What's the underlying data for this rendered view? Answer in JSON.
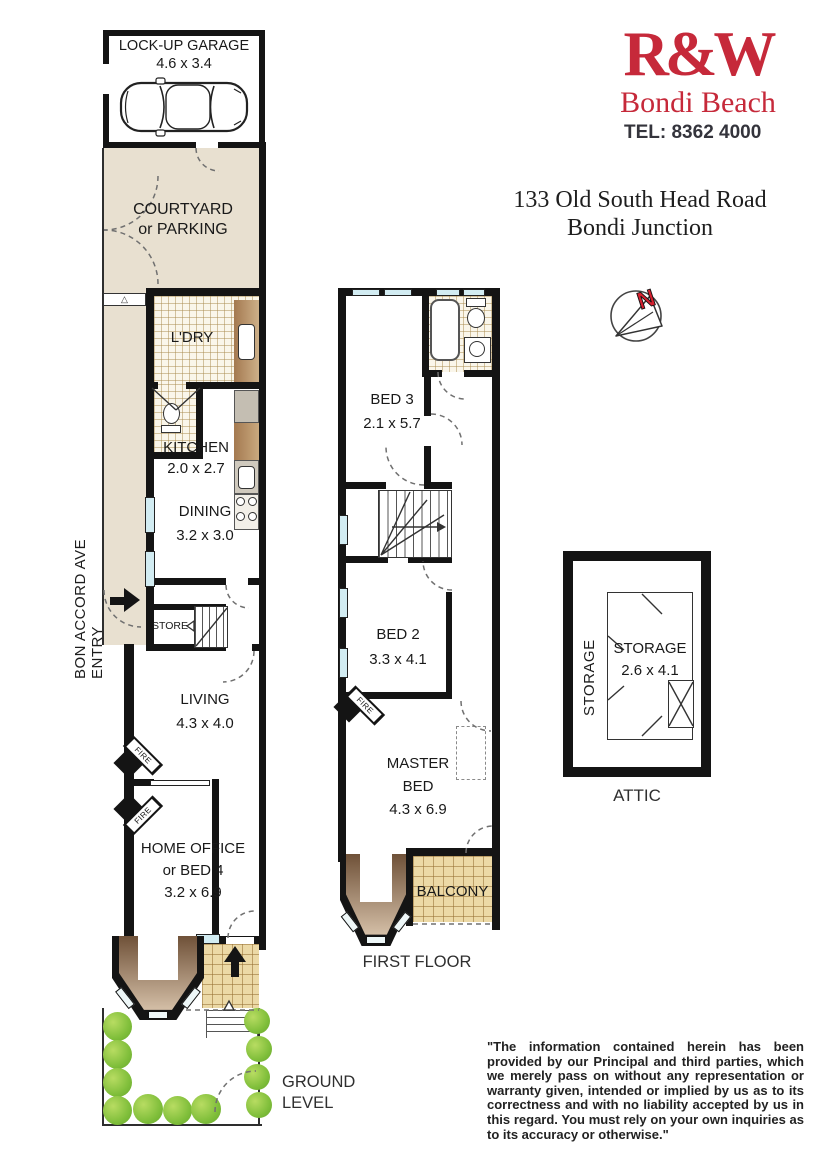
{
  "branding": {
    "logo_text": "R&W",
    "office": "Bondi Beach",
    "phone": "TEL: 8362 4000"
  },
  "address": {
    "line1": "133 Old South Head Road",
    "line2": "Bondi Junction"
  },
  "side_street_label": "BON ACCORD AVE ENTRY",
  "compass": {
    "letter": "N"
  },
  "level_labels": {
    "ground_line1": "GROUND",
    "ground_line2": "LEVEL",
    "first": "FIRST FLOOR",
    "attic": "ATTIC"
  },
  "rooms": {
    "garage": {
      "name": "LOCK-UP GARAGE",
      "dims": "4.6 x 3.4"
    },
    "courtyard": {
      "line1": "COURTYARD",
      "line2": "or PARKING"
    },
    "laundry": {
      "name": "L'DRY"
    },
    "kitchen": {
      "name": "KITCHEN",
      "dims": "2.0 x 2.7"
    },
    "dining": {
      "name": "DINING",
      "dims": "3.2 x 3.0"
    },
    "store": {
      "name": "STORE"
    },
    "living": {
      "name": "LIVING",
      "dims": "4.3 x 4.0"
    },
    "home_office": {
      "line1": "HOME OFFICE",
      "line2": "or BED 4",
      "dims": "3.2 x 6.9"
    },
    "bed3": {
      "name": "BED 3",
      "dims": "2.1 x 5.7"
    },
    "bed2": {
      "name": "BED 2",
      "dims": "3.3 x 4.1"
    },
    "master_bed": {
      "line1": "MASTER",
      "line2": "BED",
      "dims": "4.3 x 6.9"
    },
    "balcony": {
      "name": "BALCONY"
    },
    "attic_storage": {
      "name": "STORAGE",
      "dims": "2.6 x 4.1"
    },
    "attic_storage_side": "STORAGE",
    "fire_label": "FIRE"
  },
  "colors": {
    "brand_red": "#c6293a",
    "wall_black": "#141414",
    "courtyard_beige": "#e8e0d0",
    "tile_tan": "#ecd9a6",
    "bush_green": "#7fbe3a",
    "window_blue": "#d2ecf2"
  },
  "disclaimer": "\"The information contained herein has been provided by our Principal and third parties, which we merely pass on without any representation or warranty given, intended or implied by us as to its correctness and with no liability accepted by us in this regard. You must rely on your own inquiries as to its accuracy or otherwise.\""
}
